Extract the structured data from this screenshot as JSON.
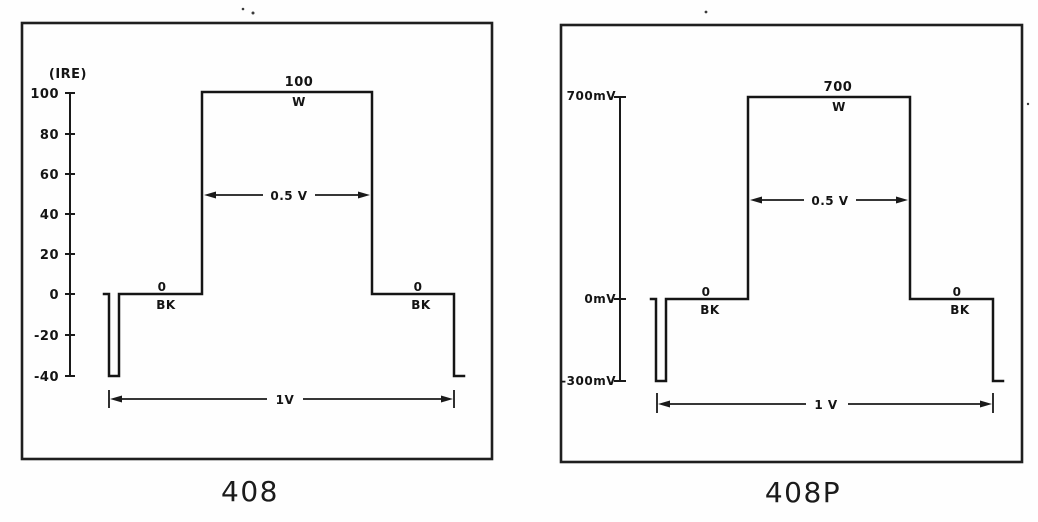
{
  "figure": {
    "background": "#fefefe",
    "line_color": "#1a1a1a",
    "panels": [
      {
        "caption": "408",
        "axis": {
          "title": "(IRE)",
          "unit": "IRE",
          "ticks": [
            "100",
            "80",
            "60",
            "40",
            "20",
            "0",
            "-20",
            "-40"
          ]
        },
        "labels": {
          "white_value": "100",
          "white_mark": "W",
          "black_left_value": "0",
          "black_left_mark": "BK",
          "black_right_value": "0",
          "black_right_mark": "BK",
          "pulse_width": "0.5 V",
          "total_width": "1V"
        },
        "signal": {
          "type": "window-pulse",
          "white_level": 100,
          "black_level": 0,
          "sync_level": -40,
          "unit": "IRE",
          "window_width": "0.5 V",
          "line_period": "1V"
        }
      },
      {
        "caption": "408P",
        "axis": {
          "title": "",
          "unit": "mV",
          "ticks": [
            "700mV",
            "0mV",
            "-300mV"
          ]
        },
        "labels": {
          "white_value": "700",
          "white_mark": "W",
          "black_left_value": "0",
          "black_left_mark": "BK",
          "black_right_value": "0",
          "black_right_mark": "BK",
          "pulse_width": "0.5 V",
          "total_width": "1 V"
        },
        "signal": {
          "type": "window-pulse",
          "white_level": 700,
          "black_level": 0,
          "sync_level": -300,
          "unit": "mV",
          "window_width": "0.5 V",
          "line_period": "1 V"
        }
      }
    ]
  }
}
